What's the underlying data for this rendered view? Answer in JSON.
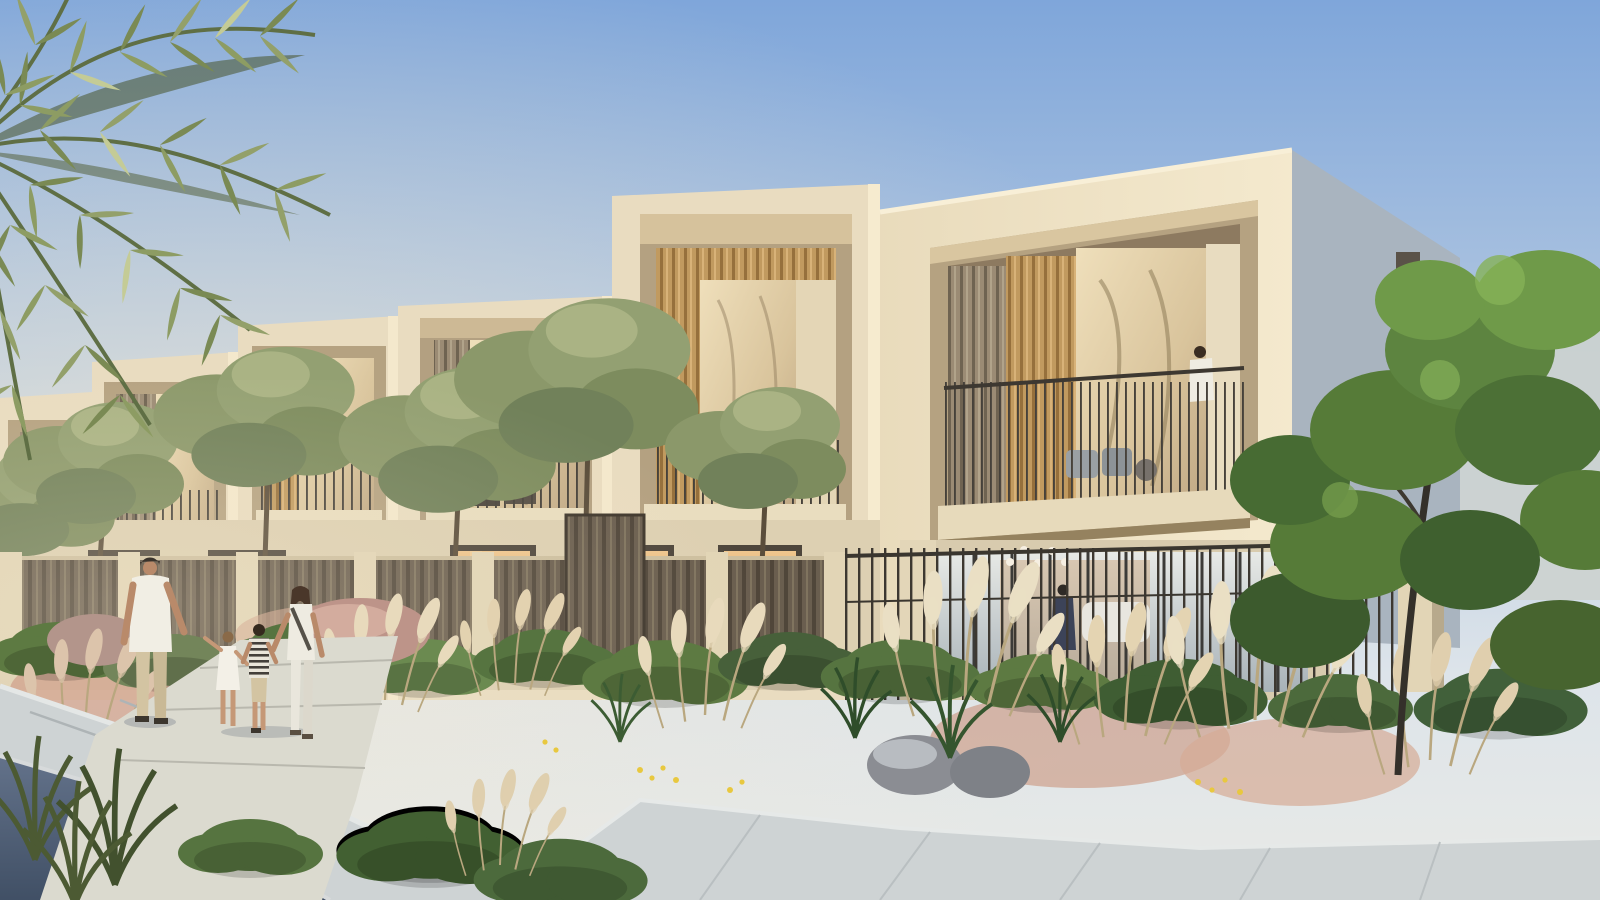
{
  "scene": {
    "type": "architectural-render",
    "setting": "Row of modern two-storey townhouses with framed wood-slat balconies at golden hour, desert landscaping in front, family walking on a path",
    "people": {
      "family_on_path": [
        "man",
        "girl",
        "boy",
        "woman"
      ],
      "balcony_figures": 2,
      "indoor_figures": 1
    },
    "vegetation": [
      "palm-fronds",
      "olive-trees",
      "ornamental-grasses",
      "pampas-plumes",
      "green-tree",
      "shrubs"
    ],
    "foreground": [
      "asphalt-road",
      "concrete-curb",
      "stone-walkway",
      "planting-beds",
      "boulders"
    ]
  },
  "palette": {
    "sky_top": "#7fa6da",
    "sky_horizon": "#e4e7e9",
    "sun_glow": "#f6ead0",
    "facade_sunlit": "#f0e4c8",
    "facade_light": "#e9dcc0",
    "facade_dim": "#ddd0b2",
    "facade_ground": "#d8cbae",
    "frame_shadow": "#b5a281",
    "recess_shadow": "#8d7a60",
    "wood_warm": "#c19a5f",
    "wood_grey": "#9b8b74",
    "glass_warm": "#e9d8b2",
    "glass_cool": "#c7d0d4",
    "window_amber": "#d89a5e",
    "side_wall": "#a9b4bf",
    "railing_dark": "#3d3831",
    "fence_panel": "#6a5e4f",
    "fence_post": "#e2d5b6",
    "olive_green": "#8b986a",
    "tree_green": "#567b38",
    "bush_green": "#567440",
    "grass_dark": "#2f4d2a",
    "plume_cream": "#e8dabc",
    "plume_pink": "#d4a692",
    "rock_grey": "#8b8d93",
    "rock_pink": "#bd9489",
    "path_light": "#dbdacf",
    "sidewalk": "#ced3d4",
    "curb": "#e6e9e8",
    "road": "#50607a",
    "skin": "#b98a6a",
    "shirt_white": "#f1eee4",
    "pants_beige": "#d3c4a2",
    "hair_dark": "#4a372a"
  }
}
